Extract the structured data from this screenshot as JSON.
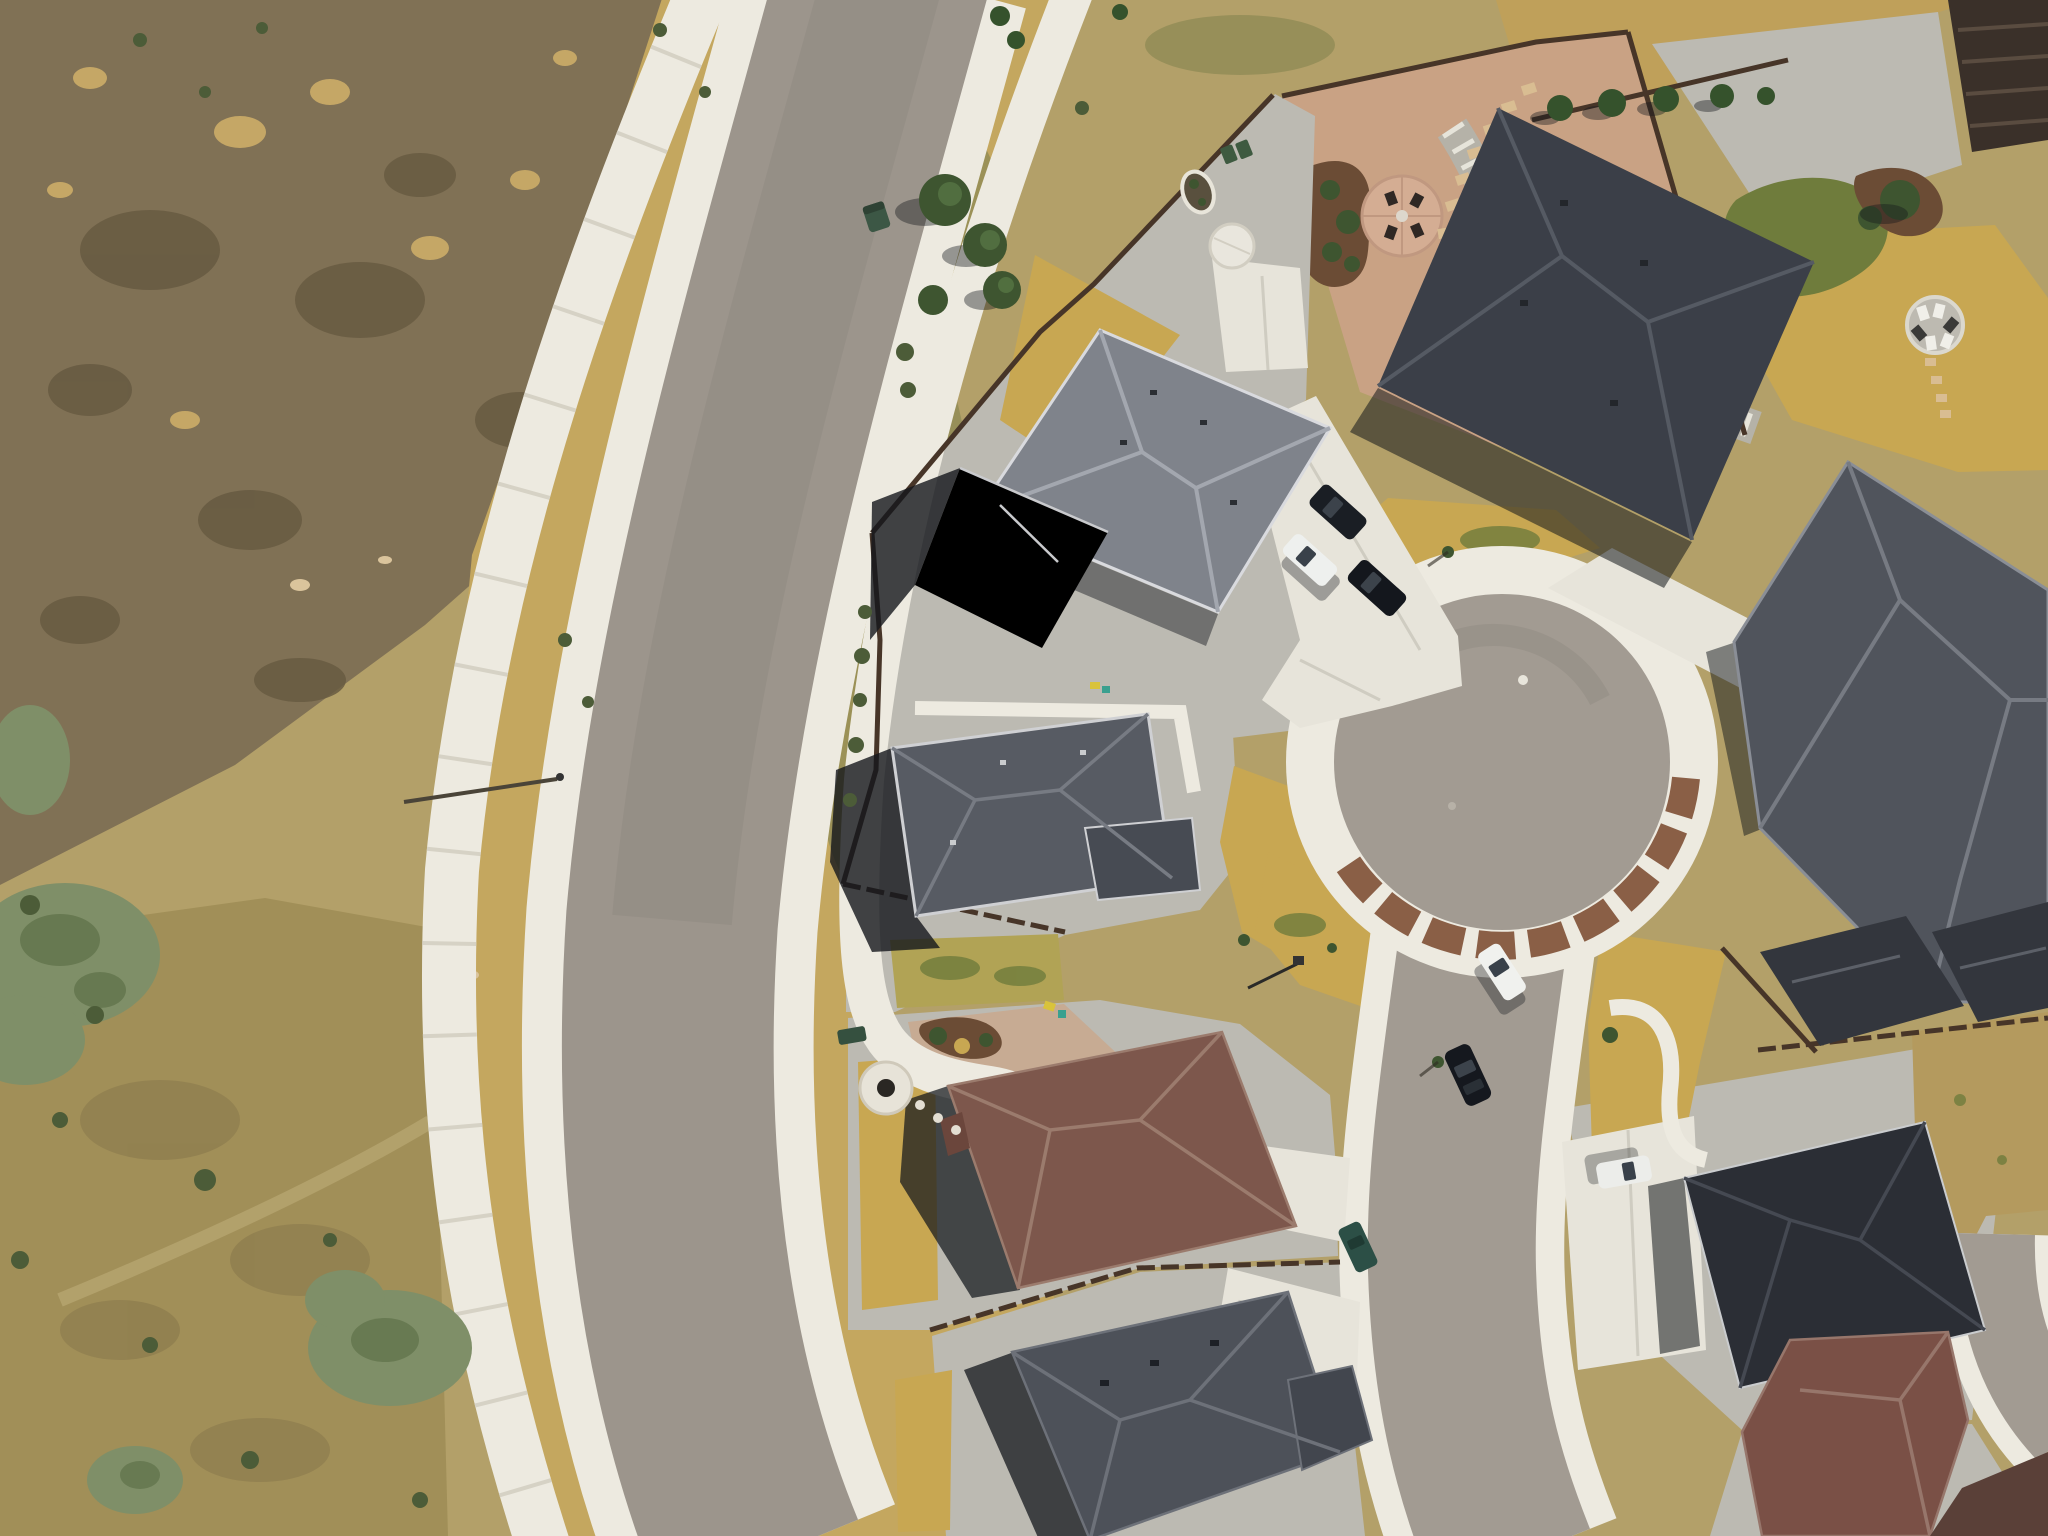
{
  "scene": {
    "type": "aerial-drone-photograph",
    "view": "top-down nadir view",
    "subject": "new suburban cul-de-sac neighborhood bordering open dry grassland",
    "lighting": "bright midday sun, shadows falling to the west-southwest",
    "left_half": "undeveloped dry scrubland with shrubs and a curving multi-use path",
    "right_half": "residential lots with grey-shingle roofs, xeriscaped gravel yards, dry yellow lawns and a circular cul-de-sac"
  },
  "palette": {
    "base": "#b3a069",
    "scrub": "#807155",
    "scrub_mottle": "#675a42",
    "scrub_bottom": "#a18f58",
    "dirt_tan": "#c5a766",
    "dirt_pale": "#dac49c",
    "gold_grass": "#c4a75f",
    "olive_tinge": "#8e8a55",
    "road_asphalt": "#9c958c",
    "street_asphalt": "#a29b92",
    "sidewalk": "#edeae0",
    "path_joint": "#d6d2c5",
    "concrete": "#e7e4da",
    "concrete_joint": "#cfccc1",
    "gravel": "#bcbab2",
    "gravel_pink": "#c7ab93",
    "backyard_pink": "#c9a284",
    "paver": "#8a5f46",
    "mulch": "#6b4c35",
    "river_rock": "#b5b2a8",
    "rock_white": "#e6e4da",
    "lawn_yellow": "#c8a752",
    "lawn_olive": "#b1a355",
    "lawn_green": "#6f7c3c",
    "field_tan": "#bfa05a",
    "field_right": "#b49a5e",
    "shadow": "#14171c",
    "fence": "#473528",
    "slats": "#3a3029",
    "tree": "#3e5530",
    "pine": "#35522c",
    "shrub": "#4c5c38",
    "sage": "#7f8f68",
    "car_glass": "#39414a",
    "trash_green": "#3e5a40",
    "utility_green": "#3c5745",
    "white_pad": "#e9e6dd"
  },
  "roads": {
    "main_road": "two-lane asphalt collector sweeping in a C-curve from top-center to bottom-left, concrete sidewalks on both sides",
    "outer_path": "detached white concrete multi-use path curving through the grassland west of the road",
    "second_path": "lot-frontage concrete path east of the road that bends into the brown-roof lot",
    "culdesac_street": "short street with circular cul-de-sac bulb, white curb ring and brown paver accent band, exiting toward bottom of frame",
    "right_edge_road": "sliver of a parallel street visible at the far bottom-right edge"
  },
  "culdesac": {
    "shape": "circular bulb",
    "ring": "white concrete sidewalk ring",
    "accent": "brown paver band on south-east arc"
  },
  "houses": [
    {
      "id": "top-center",
      "roof_color": "#7f838b",
      "description": "light grey hip roof with white gutters, dark shadowed wing, gravel backyard with oval planter, round white pad, concrete patio and two green bins"
    },
    {
      "id": "top-right",
      "roof_color": "#3b3f48",
      "description": "large dark slate hip roof; backyard of pink gravel with circular sitting patio, four chairs, kidney mulch bed, dry-creek river rock and stepping stones inside wood fence"
    },
    {
      "id": "right",
      "roof_color": "#50545c",
      "description": "big grey shingle hip roof at right edge; golden back lawn with round lounge patio and stepping stones"
    },
    {
      "id": "center-left",
      "roof_color": "#575b63",
      "description": "grey hip roof with white ridge caps and L-wing, gravel yard, dry lawn patches"
    },
    {
      "id": "center-brown",
      "roof_color": "#7d574c",
      "description": "maroon-brown hip roof; pink gravel front yard with white fire-pit circle and winding walkway"
    },
    {
      "id": "bottom-center",
      "roof_color": "#4d5159",
      "description": "large dark grey hip roof with garage wing and concrete driveway to the street"
    },
    {
      "id": "bottom-right",
      "roof_color": "#2b2e35",
      "description": "nearly black hip roof with white car parked on concrete driveway"
    },
    {
      "id": "bottom-corner-brown",
      "roof_color": "#7a5046",
      "description": "brown shingle roof entering frame at bottom-right corner"
    },
    {
      "id": "right-edge-row",
      "roof_color": "#33363d",
      "description": "row of dark roofs along the upper right edge behind a wood fence"
    },
    {
      "id": "far-corner",
      "roof_color": "#5a4038",
      "description": "dark brown roof beyond the corner street sliver"
    }
  ],
  "vehicles": [
    {
      "type": "car",
      "color": "white",
      "hex": "#eef0ee",
      "location": "driveway apron north-west of cul-de-sac"
    },
    {
      "type": "suv",
      "color": "black",
      "hex": "#1a1e24",
      "location": "driveway apron north-west of cul-de-sac"
    },
    {
      "type": "car",
      "color": "black",
      "hex": "#14171d",
      "location": "driveway apron beside white car"
    },
    {
      "type": "car",
      "color": "white",
      "hex": "#f0f1ee",
      "location": "street south of cul-de-sac, right curb"
    },
    {
      "type": "car",
      "color": "black",
      "hex": "#15181e",
      "location": "street south of cul-de-sac, right curb"
    },
    {
      "type": "car",
      "color": "dark teal",
      "hex": "#2c4f46",
      "location": "left edge of street near bottom"
    },
    {
      "type": "car",
      "color": "white",
      "hex": "#ecedea",
      "location": "driveway of bottom-right dark-roof house"
    }
  ],
  "features": [
    "green curbside trash bin on main road edge",
    "green utility boxes",
    "street-lamp shadow across grass strip",
    "mailbox post near street",
    "manhole covers on cul-de-sac",
    "white fire-pit circle in brown-roof front yard",
    "round white pad and oval planter behind top-center house",
    "stepping-stone paths",
    "kids toys in gravel yard"
  ],
  "vegetation": {
    "left": "sage-green rabbitbrush clusters and small dark shrubs on dry range",
    "center": "group of young green trees beside frontage path",
    "top_right": "row of small pines along back fence",
    "lawns": "drought-yellow turf with a few green patches"
  }
}
